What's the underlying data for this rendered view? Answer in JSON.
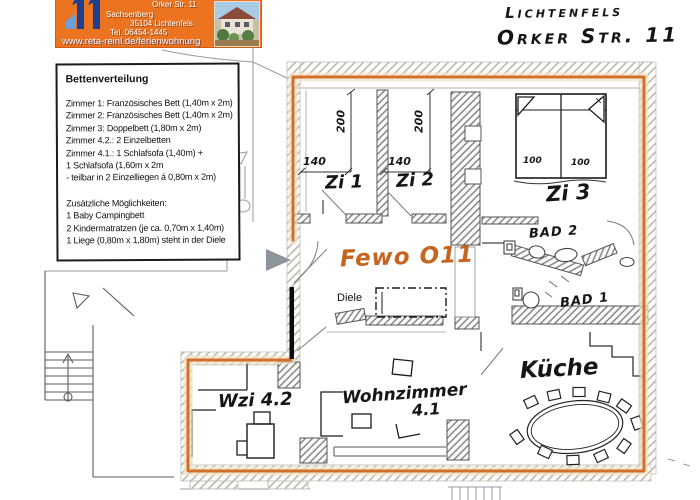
{
  "banner": {
    "bg_color": "#ec7420",
    "logo_color": "#1d3f8f",
    "address_line1": "Orker Str. 11",
    "address_line2": "Sachsenberg",
    "address_line3": "35104 Lichtenfels",
    "address_line4": "Tel. 06454-1445",
    "website": "www.reta-reinl.de/ferienwohnung"
  },
  "handwritten_header": {
    "city": "Lichtenfels",
    "street": "Orker Str. 11"
  },
  "legend": {
    "title": "Bettenverteilung",
    "lines": [
      "Zimmer 1: Französisches Bett (1,40m x 2m)",
      "Zimmer 2: Französisches Bett (1,40m x 2m)",
      "Zimmer 3: Doppelbett (1,80m x 2m)",
      "Zimmer 4.2.: 2 Einzelbetten",
      "Zimmer 4.1.: 1 Schlafsofa (1,40m) +",
      "1 Schlafsofa (1,60m x 2m",
      " - teilbar in 2 Einzelliegen á 0,80m x 2m)",
      "Zusätzliche Möglichkeiten:",
      "1 Baby Campingbett",
      "2 Kindermatratzen (je ca. 0,70m x 1,40m)",
      "1 Liege (0,80m x 1,80m) steht in der Diele"
    ]
  },
  "plan": {
    "apartment_label": "Fewo O11",
    "accent_color": "#d2691e",
    "labels": {
      "zi1": "Zi 1",
      "zi2": "Zi 2",
      "zi3": "Zi 3",
      "bad2": "Bad 2",
      "bad1": "Bad 1",
      "kueche": "Küche",
      "wzi42": "Wzi 4.2",
      "wohnzimmer": "Wohnzimmer",
      "wohnzimmer_nr": "4.1",
      "diele": "Diele"
    },
    "dimensions": {
      "zi1_w": "140",
      "zi1_d": "200",
      "zi2_w": "140",
      "zi2_d": "200",
      "zi3_l": "100",
      "zi3_r": "100"
    }
  }
}
